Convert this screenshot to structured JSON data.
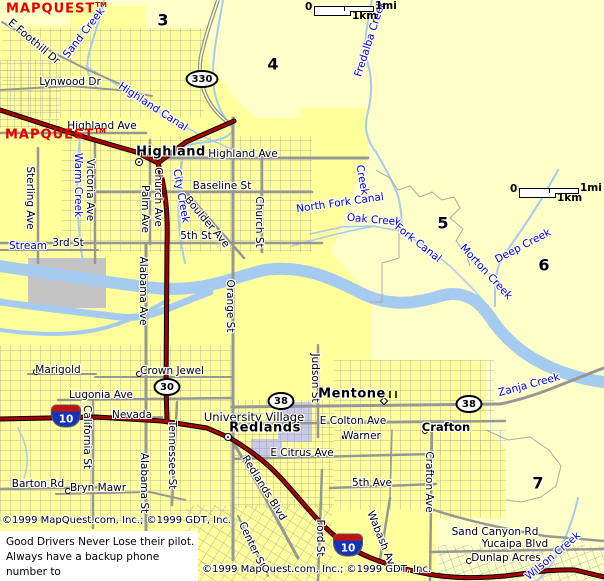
{
  "watermark": {
    "text": "MAPQUEST",
    "tm": "TM"
  },
  "scalebar": {
    "zero": "0",
    "mi": "1mi",
    "km": "1km"
  },
  "copyright": {
    "text": "©1999 MapQuest.com, Inc.; ©1999 GDT, Inc."
  },
  "ad": {
    "lines": [
      "Good Drivers Never Lose their pilot.",
      "Always have a backup phone number to",
      "call in event you do lose contact."
    ]
  },
  "grid_numbers": [
    {
      "t": "3",
      "x": 163,
      "y": 20
    },
    {
      "t": "4",
      "x": 273,
      "y": 64
    },
    {
      "t": "5",
      "x": 443,
      "y": 223
    },
    {
      "t": "6",
      "x": 544,
      "y": 265
    },
    {
      "t": "7",
      "x": 538,
      "y": 483
    }
  ],
  "shields": [
    {
      "type": "ellipse",
      "t": "330",
      "x": 202,
      "y": 79,
      "w": 33
    },
    {
      "type": "ellipse",
      "t": "30",
      "x": 167,
      "y": 387
    },
    {
      "type": "ellipse",
      "t": "38",
      "x": 281,
      "y": 401
    },
    {
      "type": "ellipse",
      "t": "38",
      "x": 469,
      "y": 404
    },
    {
      "type": "interstate",
      "t": "10",
      "x": 66,
      "y": 416
    },
    {
      "type": "interstate",
      "t": "10",
      "x": 348,
      "y": 545
    }
  ],
  "markers": [
    {
      "type": "circledot",
      "x": 139,
      "y": 162,
      "name": "highland-city-marker"
    },
    {
      "type": "circledot",
      "x": 228,
      "y": 437,
      "name": "redlands-city-marker"
    },
    {
      "type": "diamond",
      "x": 384,
      "y": 401,
      "name": "mentone-city-marker"
    },
    {
      "type": "diamond",
      "x": 296,
      "y": 421,
      "name": "university-village-marker"
    },
    {
      "type": "circle",
      "x": 425,
      "y": 431,
      "name": "crafton-marker"
    },
    {
      "type": "circle",
      "x": 36,
      "y": 372,
      "name": "marigold-marker"
    },
    {
      "type": "circle",
      "x": 139,
      "y": 374,
      "name": "crown-jewel-marker"
    },
    {
      "type": "circle",
      "x": 87,
      "y": 415,
      "name": "nevada-marker"
    },
    {
      "type": "circle",
      "x": 68,
      "y": 491,
      "name": "bryn-mawr-marker"
    },
    {
      "type": "circle",
      "x": 469,
      "y": 561,
      "name": "dunlap-acres-marker"
    },
    {
      "type": "dot",
      "x": 344,
      "y": 437,
      "name": "warner-marker"
    }
  ],
  "labels": [
    {
      "t": "E Foothill Dr",
      "x": 34,
      "y": 42,
      "r": 40
    },
    {
      "t": "Lynwood Dr",
      "x": 70,
      "y": 82
    },
    {
      "t": "Highland Ave",
      "x": 102,
      "y": 126
    },
    {
      "t": "Highland Ave",
      "x": 243,
      "y": 154
    },
    {
      "t": "Baseline St",
      "x": 222,
      "y": 186
    },
    {
      "t": "5th St",
      "x": 196,
      "y": 236
    },
    {
      "t": "3rd St",
      "x": 68,
      "y": 243
    },
    {
      "t": "Boulder Ave",
      "x": 207,
      "y": 222,
      "r": 50
    },
    {
      "t": "Sterling Ave",
      "x": 30,
      "y": 198,
      "r": 90
    },
    {
      "t": "Victoria Ave",
      "x": 90,
      "y": 190,
      "r": 90
    },
    {
      "t": "Palm Ave",
      "x": 145,
      "y": 209,
      "r": 90
    },
    {
      "t": "Church Ave",
      "x": 158,
      "y": 197,
      "r": 90
    },
    {
      "t": "Church St",
      "x": 259,
      "y": 222,
      "r": 90
    },
    {
      "t": "Orange St",
      "x": 230,
      "y": 306,
      "r": 90
    },
    {
      "t": "Alabama Ave",
      "x": 143,
      "y": 291,
      "r": 90
    },
    {
      "t": "Marigold",
      "x": 58,
      "y": 370
    },
    {
      "t": "Crown Jewel",
      "x": 172,
      "y": 371
    },
    {
      "t": "Lugonia Ave",
      "x": 101,
      "y": 395
    },
    {
      "t": "Nevada",
      "x": 132,
      "y": 415
    },
    {
      "t": "University Village",
      "x": 254,
      "y": 417,
      "c": "place"
    },
    {
      "t": "E Colton Ave",
      "x": 353,
      "y": 421
    },
    {
      "t": "Warner",
      "x": 362,
      "y": 436
    },
    {
      "t": "E Citrus Ave",
      "x": 302,
      "y": 453
    },
    {
      "t": "Judson St",
      "x": 315,
      "y": 378,
      "r": 90
    },
    {
      "t": "5th Ave",
      "x": 372,
      "y": 483
    },
    {
      "t": "Redlands Blvd",
      "x": 264,
      "y": 488,
      "r": 58
    },
    {
      "t": "Tennessee St",
      "x": 172,
      "y": 455,
      "r": 90
    },
    {
      "t": "Alabama St",
      "x": 144,
      "y": 483,
      "r": 90
    },
    {
      "t": "California St",
      "x": 87,
      "y": 437,
      "r": 90
    },
    {
      "t": "Barton Rd",
      "x": 38,
      "y": 484
    },
    {
      "t": "Bryn Mawr",
      "x": 98,
      "y": 488
    },
    {
      "t": "Wabash Ave",
      "x": 382,
      "y": 541,
      "r": 68
    },
    {
      "t": "Crafton Ave",
      "x": 429,
      "y": 482,
      "r": 90
    },
    {
      "t": "Ford St",
      "x": 320,
      "y": 538,
      "r": 90
    },
    {
      "t": "Center St",
      "x": 252,
      "y": 545,
      "r": 65
    },
    {
      "t": "Sand Canyon Rd",
      "x": 495,
      "y": 532
    },
    {
      "t": "Yucaipa Blvd",
      "x": 515,
      "y": 544
    },
    {
      "t": "Dunlap Acres",
      "x": 506,
      "y": 558
    },
    {
      "t": "Highland",
      "x": 171,
      "y": 152,
      "c": "city"
    },
    {
      "t": "Redlands",
      "x": 265,
      "y": 428,
      "c": "city"
    },
    {
      "t": "Mentone",
      "x": 352,
      "y": 394,
      "c": "city"
    },
    {
      "t": "Crafton",
      "x": 446,
      "y": 427,
      "c": "city-small"
    },
    {
      "t": "Sand Creek",
      "x": 84,
      "y": 33,
      "r": -52,
      "c": "water"
    },
    {
      "t": "Fredalba Creek",
      "x": 370,
      "y": 39,
      "r": -72,
      "c": "water"
    },
    {
      "t": "Highland Canal",
      "x": 153,
      "y": 107,
      "r": 33,
      "c": "water"
    },
    {
      "t": "Warm Creek",
      "x": 78,
      "y": 185,
      "r": 90,
      "c": "water"
    },
    {
      "t": "City Creek",
      "x": 181,
      "y": 196,
      "r": 80,
      "c": "water"
    },
    {
      "t": "Stream",
      "x": 28,
      "y": 246,
      "c": "water"
    },
    {
      "t": "North Fork Canal",
      "x": 340,
      "y": 203,
      "r": -8,
      "c": "water"
    },
    {
      "t": "Oak Creek",
      "x": 374,
      "y": 220,
      "r": 5,
      "c": "water"
    },
    {
      "t": "Creek",
      "x": 362,
      "y": 180,
      "r": 80,
      "c": "water"
    },
    {
      "t": "Fork Canal",
      "x": 418,
      "y": 243,
      "r": 38,
      "c": "water"
    },
    {
      "t": "Morton Creek",
      "x": 486,
      "y": 272,
      "r": 47,
      "c": "water"
    },
    {
      "t": "Deep Creek",
      "x": 523,
      "y": 246,
      "r": -28,
      "c": "water"
    },
    {
      "t": "Zanja Creek",
      "x": 529,
      "y": 385,
      "r": -15,
      "c": "water"
    },
    {
      "t": "Wilson Creek",
      "x": 553,
      "y": 556,
      "r": -40,
      "c": "water"
    }
  ],
  "colors": {
    "open_land": "#FFFFC8",
    "urban": "#FFFF9C",
    "water": "#A6CBF0",
    "water_text": "#0000C8",
    "road_gray": "#979797",
    "highway_red": "#A40000",
    "landuse_gray": "#C4C4C4",
    "campus_purple": "#C9C9E8",
    "watermark_red": "#E60000"
  }
}
